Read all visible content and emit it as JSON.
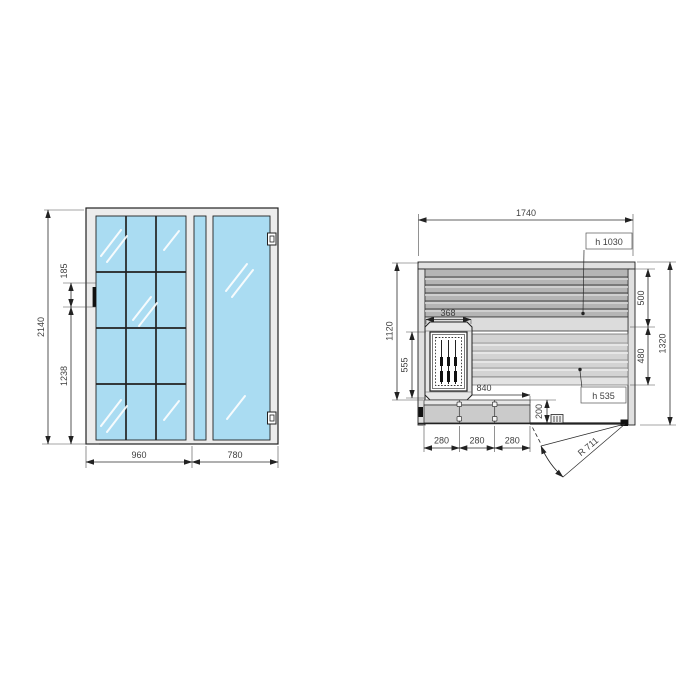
{
  "diagram": {
    "type": "technical-drawing",
    "subject": "sauna cabin: glass front elevation and floor plan with benches, heater and door swing",
    "front_view": {
      "height_total": "2140",
      "handle_section": "185",
      "handle_bottom_from_floor": "1238",
      "glass_wall_width": "960",
      "door_width": "780"
    },
    "plan_view": {
      "width_total": "1740",
      "depth_total": "1320",
      "depth_interior": "1120",
      "heater_depth": "555",
      "heater_width": "368",
      "bench_upper_depth": "500",
      "bench_lower_depth": "480",
      "bench_upper_height": "h 1030",
      "bench_lower_height": "h 535",
      "step_length": "840",
      "step_segments": [
        "280",
        "280",
        "280"
      ],
      "step_depth": "200",
      "door_swing_radius": "R 711"
    },
    "colors": {
      "glass": "#aadcf2",
      "frame": "#ececec",
      "wall": "#e0e0e0",
      "bench_upper": "#b5b5b5",
      "bench_lower": "#d3d3d3",
      "line": "#222222"
    }
  }
}
